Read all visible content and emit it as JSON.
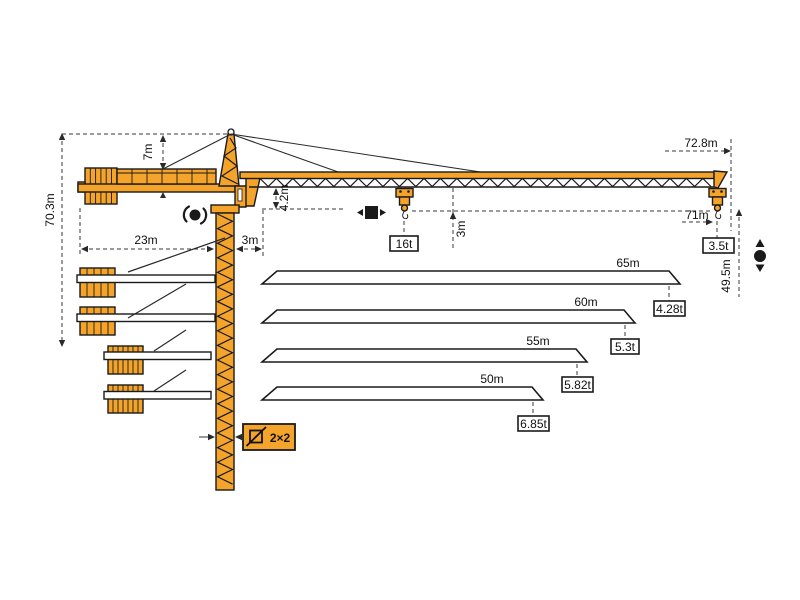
{
  "diagram_type": "tower-crane-dimension-and-load-chart",
  "colors": {
    "crane_orange": "#F5A42B",
    "outline": "#1A1A1A",
    "dimension_lines": "#3A3A3A",
    "background": "#FFFFFF"
  },
  "labels": {
    "total_height": "70.3m",
    "head_height": "7m",
    "counterjib_radius": "23m",
    "mast_to_pivot": "3m",
    "jib_foot_drop": "4.2m",
    "hook_to_jib": "3m",
    "max_radius": "72.8m",
    "tip_hook_radius": "71m",
    "hook_height": "49.5m",
    "max_load": "16t",
    "tip_load": "3.5t",
    "mast_section": "2×2"
  },
  "jib_options": [
    {
      "length": "65m",
      "tip_load": "4.28t"
    },
    {
      "length": "60m",
      "tip_load": "5.3t"
    },
    {
      "length": "55m",
      "tip_load": "5.82t"
    },
    {
      "length": "50m",
      "tip_load": "6.85t"
    }
  ],
  "symbols": {
    "slewing": "slewing-rotation",
    "trolley_travel": "trolley-travel",
    "hoist": "hook-hoist-up-down",
    "mast_cross_section": "mast-cross-section-2x2"
  }
}
